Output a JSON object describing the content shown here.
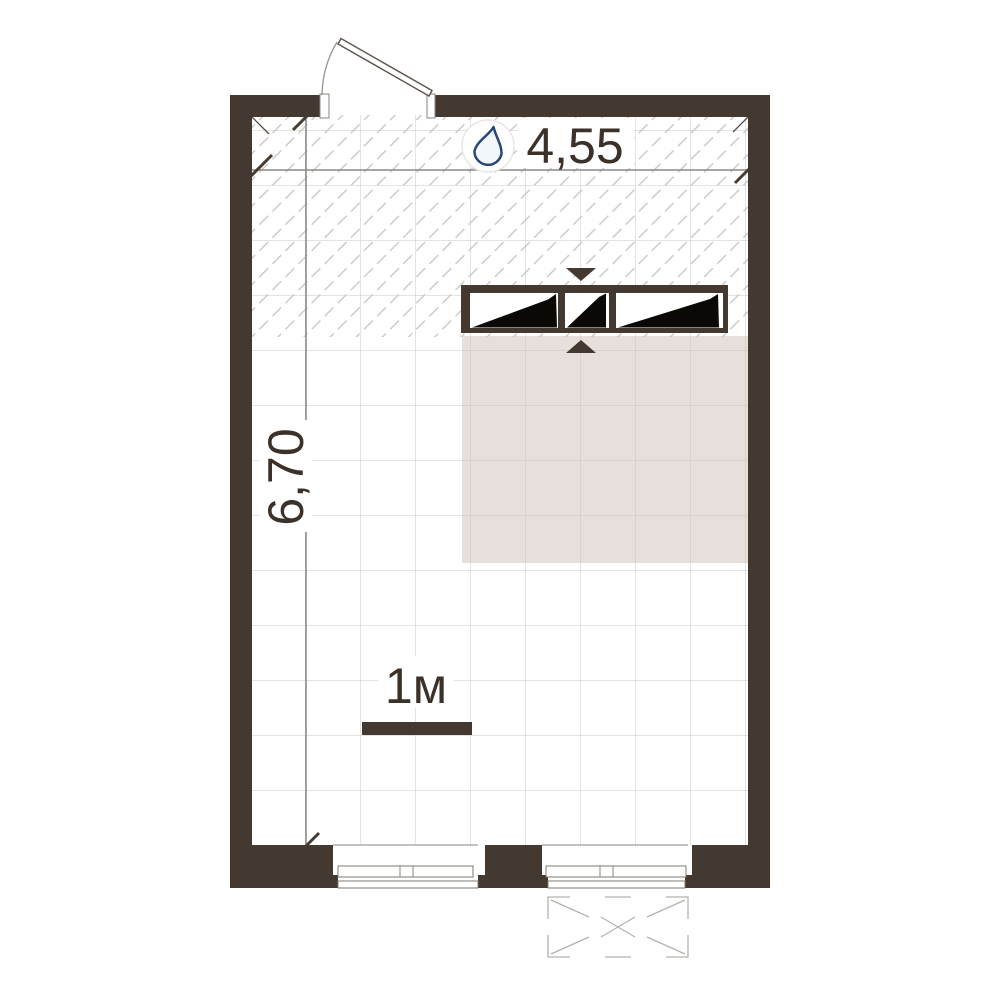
{
  "plan": {
    "dim_width_label": "4,55",
    "dim_height_label": "6,70",
    "scale_label": "1м",
    "icons": {
      "wet_zone": "water-drop-icon",
      "wardrobe_arrow_down": "arrow-down-icon",
      "wardrobe_arrow_up": "arrow-up-icon"
    },
    "colors": {
      "wall": "#443930",
      "furniture_zone": "#e6dfdb",
      "grid_line": "#cac7c4",
      "hatch_line": "#cbc8c5",
      "dimension_line": "#8c8884",
      "dimension_tick": "#473c31",
      "text": "#3b3129",
      "balcony_line": "#b5b2ae",
      "water_drop_outline": "#2a4677",
      "water_drop_fill": "#6b9bd4"
    }
  }
}
